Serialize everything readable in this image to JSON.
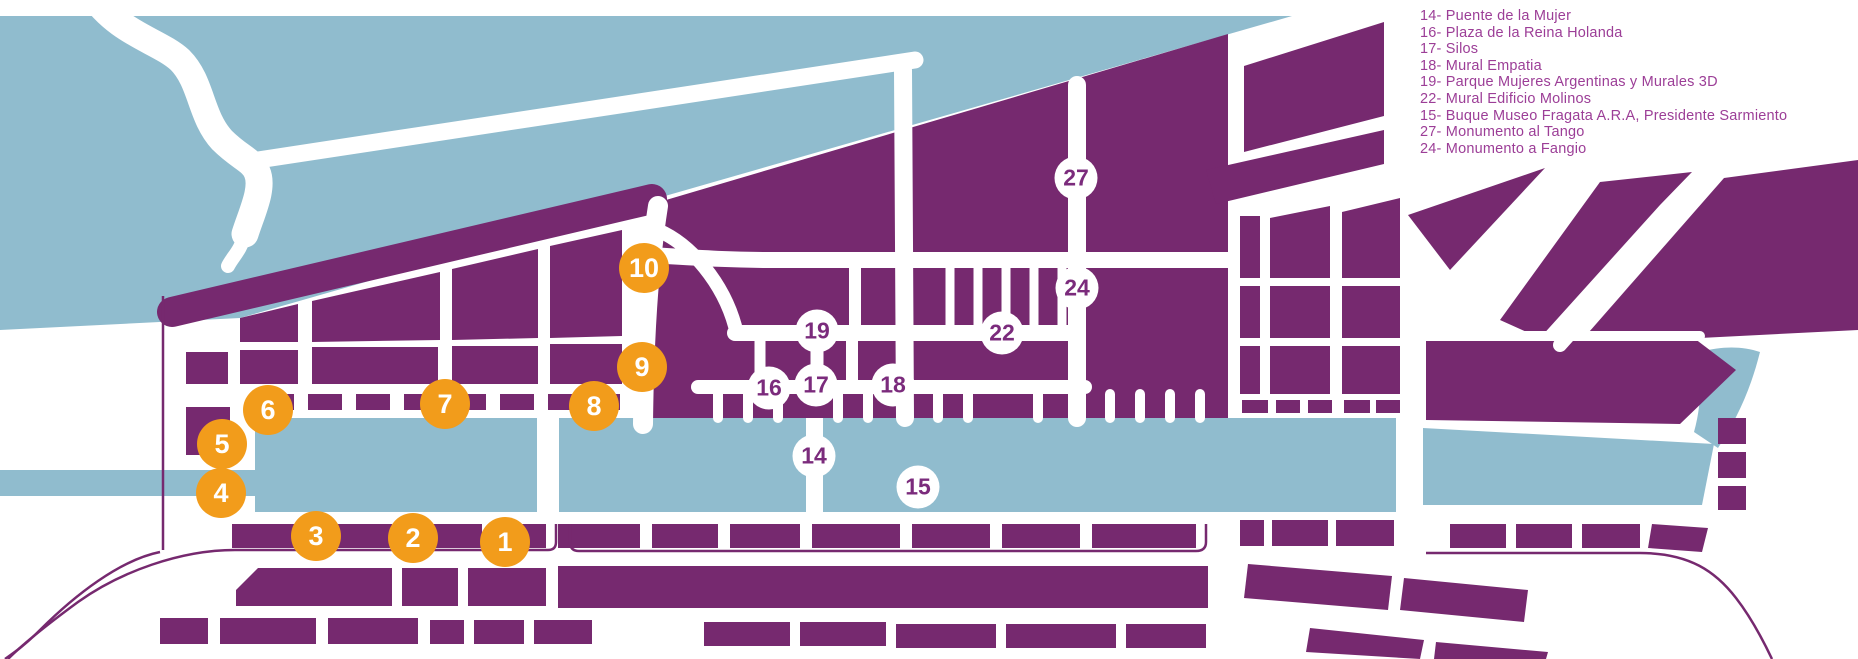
{
  "colors": {
    "block_purple": "#76296F",
    "water_blue": "#90BCCE",
    "marker_orange": "#F29C1B",
    "marker_number_purple": "#7B2B7C",
    "legend_text_purple": "#9C3E97",
    "background_white": "#FFFFFF"
  },
  "legend": {
    "items": [
      {
        "number": "14",
        "label": "Puente de la Mujer",
        "text": "14- Puente de la Mujer"
      },
      {
        "number": "16",
        "label": "Plaza de la Reina Holanda",
        "text": "16- Plaza de la Reina Holanda"
      },
      {
        "number": "17",
        "label": "Silos",
        "text": "17- Silos"
      },
      {
        "number": "18",
        "label": "Mural Empatia",
        "text": "18- Mural Empatia"
      },
      {
        "number": "19",
        "label": "Parque Mujeres Argentinas y Murales 3D",
        "text": "19- Parque Mujeres Argentinas y Murales 3D"
      },
      {
        "number": "22",
        "label": "Mural Edificio Molinos",
        "text": "22- Mural Edificio Molinos"
      },
      {
        "number": "15",
        "label": "Buque Museo Fragata A.R.A, Presidente Sarmiento",
        "text": "15- Buque Museo Fragata A.R.A, Presidente Sarmiento"
      },
      {
        "number": "27",
        "label": "Monumento al Tango",
        "text": "27- Monumento al Tango"
      },
      {
        "number": "24",
        "label": "Monumento a Fangio",
        "text": "24- Monumento a Fangio"
      }
    ]
  },
  "markers": [
    {
      "label": "1",
      "style": "orange",
      "x": 505,
      "y": 542
    },
    {
      "label": "2",
      "style": "orange",
      "x": 413,
      "y": 538
    },
    {
      "label": "3",
      "style": "orange",
      "x": 316,
      "y": 536
    },
    {
      "label": "4",
      "style": "orange",
      "x": 221,
      "y": 493
    },
    {
      "label": "5",
      "style": "orange",
      "x": 222,
      "y": 444
    },
    {
      "label": "6",
      "style": "orange",
      "x": 268,
      "y": 410
    },
    {
      "label": "7",
      "style": "orange",
      "x": 445,
      "y": 404
    },
    {
      "label": "8",
      "style": "orange",
      "x": 594,
      "y": 406
    },
    {
      "label": "9",
      "style": "orange",
      "x": 642,
      "y": 367
    },
    {
      "label": "10",
      "style": "orange",
      "x": 644,
      "y": 268
    },
    {
      "label": "14",
      "style": "white",
      "x": 814,
      "y": 456
    },
    {
      "label": "15",
      "style": "white",
      "x": 918,
      "y": 487
    },
    {
      "label": "16",
      "style": "white",
      "x": 769,
      "y": 388
    },
    {
      "label": "17",
      "style": "white",
      "x": 816,
      "y": 385
    },
    {
      "label": "18",
      "style": "white",
      "x": 893,
      "y": 385
    },
    {
      "label": "19",
      "style": "white",
      "x": 817,
      "y": 331
    },
    {
      "label": "22",
      "style": "white",
      "x": 1002,
      "y": 333
    },
    {
      "label": "24",
      "style": "white",
      "x": 1077,
      "y": 288
    },
    {
      "label": "27",
      "style": "white",
      "x": 1076,
      "y": 178
    }
  ]
}
